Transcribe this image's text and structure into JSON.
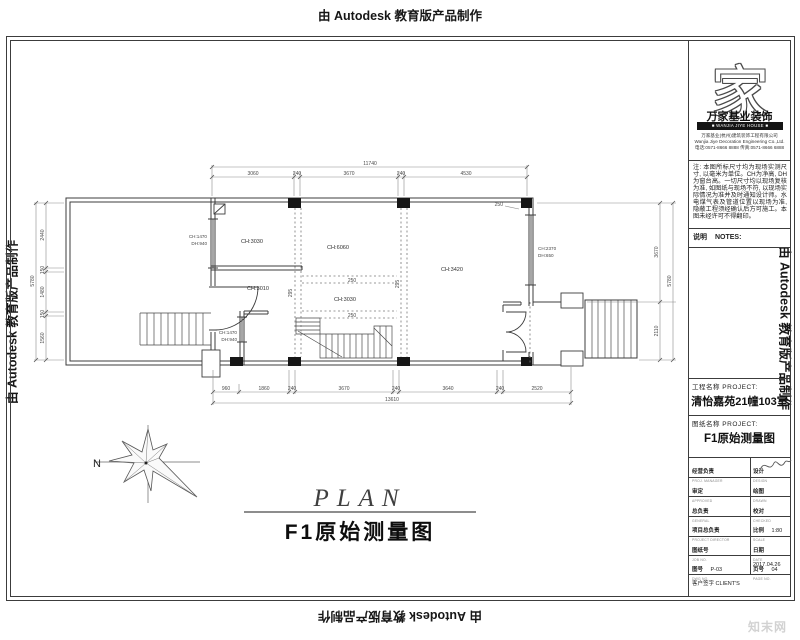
{
  "banner": "由 Autodesk 教育版产品制作",
  "watermark": "知末网",
  "caption": {
    "title": "PLAN",
    "subtitle": "F1原始测量图"
  },
  "title_block": {
    "logo_char": "家",
    "company_name": "万家基业装饰",
    "company_banner": "■ WANJIA JIYE HOUSE ■",
    "company_lines": [
      "万家基业(杭州)建筑装饰工程有限公司",
      "Wanjia Jiye Decoration Engineering Co.,Ltd.",
      "电话:0571-8666 8888  传真:0571-8666 6888"
    ],
    "notes_text": "注: 本图所标尺寸均为现场实测尺寸, 以毫米为单位。CH为净高, DH为窗台高。一切尺寸均以现场复核为准, 如图纸与现场不符, 以现场实际情况为准并及时通知设计师。水电煤气表及管道位置以现场为准, 隐蔽工程须经确认后方可施工。本图未经许可不得翻印。",
    "notes_label": "说明",
    "notes_label_en": "NOTES:",
    "project_label": "工程名称 PROJECT:",
    "project_value": "清怡嘉苑21幢103室",
    "drawing_label": "图纸名称 PROJECT:",
    "drawing_value": "F1原始测量图",
    "rows": [
      {
        "l": "经营负责",
        "lsub": "PROJ. MANAGER",
        "r": "设计",
        "rsub": "DESIGN",
        "rval": ""
      },
      {
        "l": "审定",
        "lsub": "APPROVED",
        "r": "绘图",
        "rsub": "DRAWN",
        "rval": ""
      },
      {
        "l": "总负责",
        "lsub": "GENERAL",
        "r": "校对",
        "rsub": "CHECKED",
        "rval": ""
      },
      {
        "l": "项目总负责",
        "lsub": "PROJECT DIRECTOR",
        "r": "比例",
        "rsub": "SCALE",
        "rval": "1:80"
      },
      {
        "l": "图纸号",
        "lsub": "JOB NO.",
        "r": "日期",
        "rsub": "DATE",
        "rval": "2017.04.26"
      },
      {
        "l": "图号",
        "lsub": "DWG NO.",
        "lval": "P-03",
        "r": "页号",
        "rsub": "PAGE NO.",
        "rval": "04"
      }
    ],
    "client_label": "客户签字 CLIENT'S"
  },
  "plan": {
    "dim_top": {
      "total": "11740",
      "segs": [
        "3060",
        "240",
        "3670",
        "240",
        "4530"
      ]
    },
    "dim_bottom": {
      "total": "13610",
      "segs": [
        "960",
        "1860",
        "240",
        "3670",
        "240",
        "3640",
        "240",
        "2520"
      ]
    },
    "dim_left": {
      "total": "5780",
      "segs": [
        "2440",
        "150",
        "1480",
        "150",
        "1560"
      ]
    },
    "dim_right": {
      "total": "5780",
      "segs": [
        "3670",
        "2110"
      ]
    },
    "rooms": [
      "CH:3030",
      "CH:6060",
      "CH:3010",
      "CH:3030",
      "CH:3420"
    ],
    "win_small": [
      "CH:1470",
      "DH:940"
    ],
    "win_entry": [
      "CH:2370",
      "DH:650"
    ],
    "beam_250": "250",
    "beam_295": "295",
    "leader_250": "250",
    "north": "N"
  }
}
